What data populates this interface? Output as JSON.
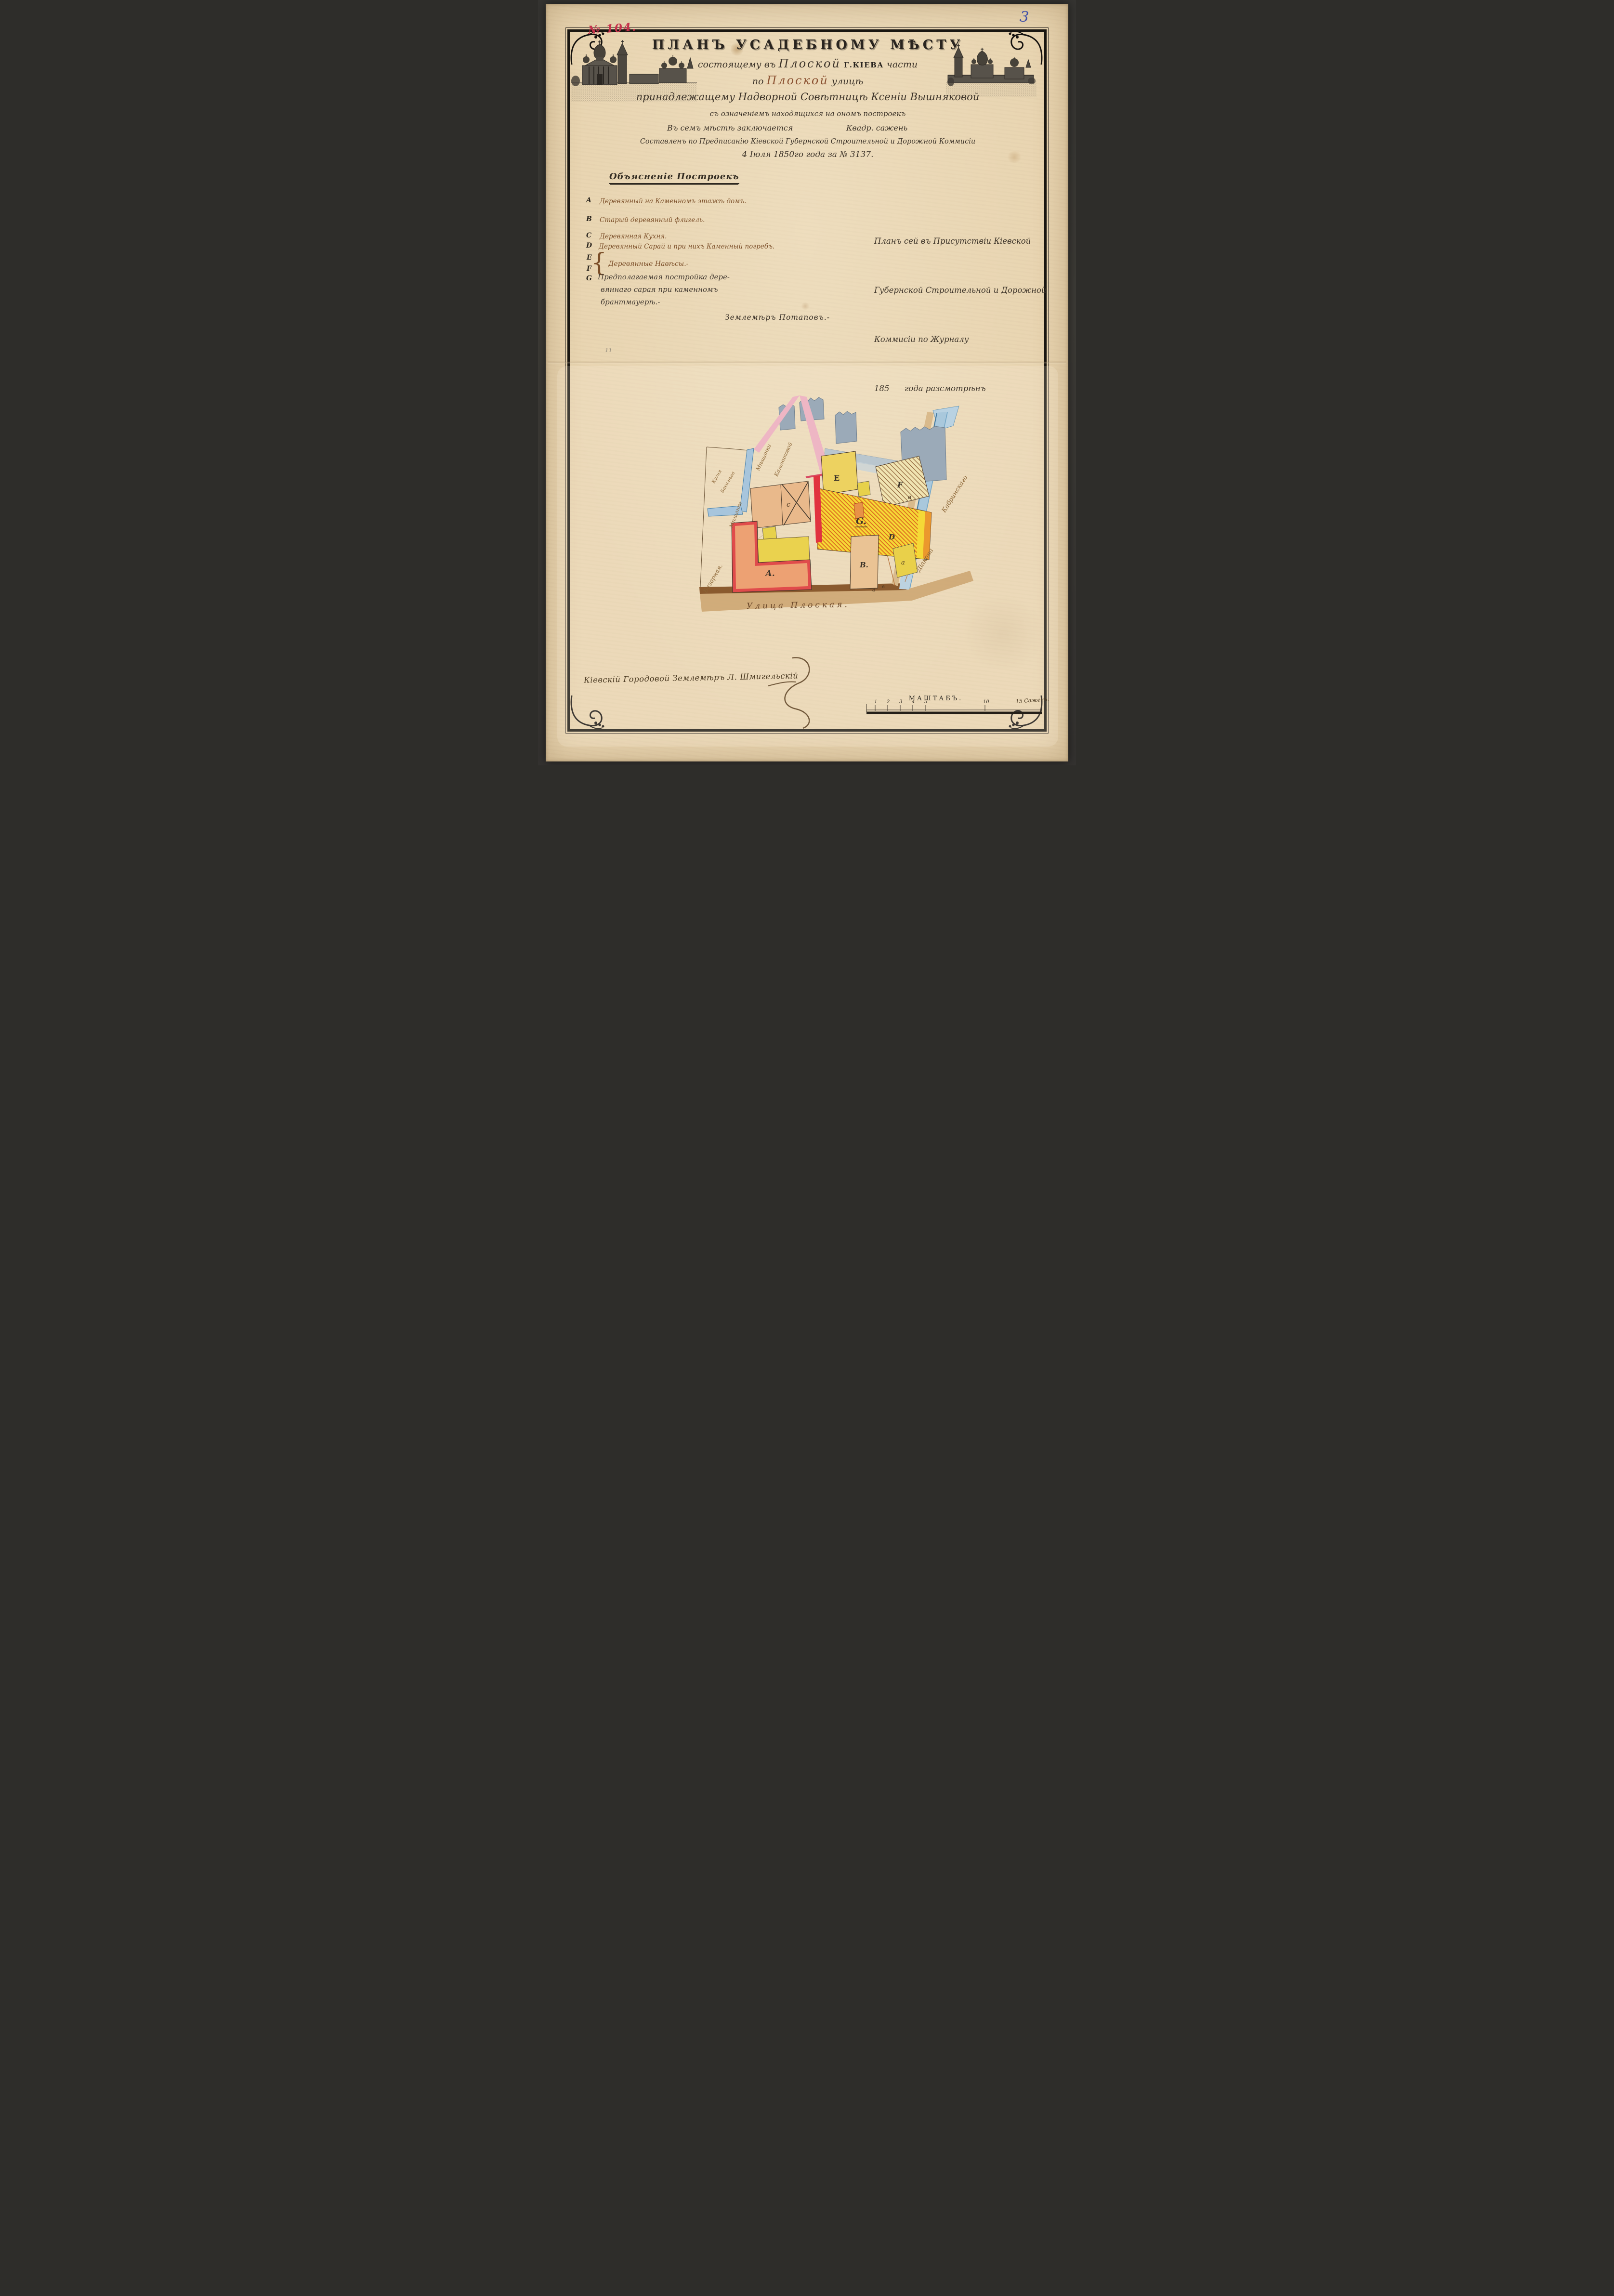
{
  "meta": {
    "doc_no": "№ 104.",
    "page_mark": "3",
    "pencil_mark": "11"
  },
  "title": {
    "main": "ПЛАНЪ УСАДЕБНОМУ МѢСТУ",
    "l2_pre": "состоящему въ",
    "l2_name": "Плоской",
    "l2_city": "Г.КІЕВА",
    "l2_post": "части",
    "l3_pre": "по",
    "l3_name": "Плоской",
    "l3_post": "улицѣ",
    "l4": "принадлежащему Надворной Совѣтницѣ Ксеніи Вышняковой",
    "l5": "съ означеніемъ находящихся на ономъ построекъ",
    "l6_left": "Въ семъ мѣстѣ заключается",
    "l6_right": "Квадр. сажень",
    "l7": "Составленъ по Предписанію Кіевской Губернской Строительной и Дорожной Коммисіи",
    "l8": "4 Іюля 1850го года за № 3137."
  },
  "legend": {
    "header": "Объясненіе Построекъ",
    "items": [
      {
        "letter": "A",
        "text": "Деревянный на Каменномъ этажѣ домъ."
      },
      {
        "letter": "B",
        "text": "Старый деревянный флигель."
      },
      {
        "letter": "C",
        "text": "Деревянная Кухня."
      },
      {
        "letter": "D",
        "text": "Деревянный Сарай и при нихъ Каменный погребъ."
      }
    ],
    "ef": {
      "letter_e": "E",
      "letter_f": "F",
      "text": "Деревянные Навѣсы.-"
    },
    "g": {
      "letter": "G",
      "line1": "Предполагаемая постройка дере-",
      "line2": "вяннаго сарая при каменномъ",
      "line3": "брантмауерѣ.-"
    },
    "note_sig": "Землемѣръ Потаповъ.-"
  },
  "approval": {
    "lines": [
      "Планъ сей въ Присутствіи Кіевской",
      "Губернской Строительной и Дорожной",
      "Коммисіи по Журналу",
      "185      года разсмотрѣнъ"
    ]
  },
  "plan": {
    "street_label": "Улица Плоская.",
    "buildings": {
      "a": "А.",
      "b": "В.",
      "c": "с",
      "d": "D",
      "e": "Е",
      "f": "F",
      "g": "G.",
      "shed_a": "а"
    },
    "marks": {
      "v": "в",
      "street_a": "а",
      "street_b": "в"
    },
    "neighbors": {
      "left_upper": "Мѣщанка",
      "left_lower": "Базарная.",
      "forge_1": "Кузня",
      "forge_2": "Бакалѣва",
      "north_1": "Мѣщанки",
      "north_2": "Калениковой",
      "canal_1": "Діакона",
      "canal_2": "Кабринскаго"
    }
  },
  "footer": {
    "surveyor_line": "Кіевскій Городовой Землемѣръ Л. Шмигельскій",
    "scale": {
      "title": "МАШТАБЪ.",
      "ticks": [
        "1",
        "2",
        "3",
        "4",
        "5",
        "10"
      ],
      "unit_label": "15 Саженъ."
    }
  },
  "palette": {
    "paper": "#e8d4b0",
    "ink_black": "#2e2820",
    "ink_sepia": "#7b4e28",
    "doc_no_red": "#c5314b",
    "page_mark_blue": "#4050a8",
    "plan_yellow": "#f5d936",
    "plan_hatch_orange": "#dd6820",
    "plan_red_wall": "#e1333f",
    "plan_pink": "#eeb6c4",
    "plan_blue": "#a9c8dc",
    "plan_grey": "#9baab8",
    "plan_tan": "#e9b98b",
    "street_brown": "#8a5a2e"
  }
}
